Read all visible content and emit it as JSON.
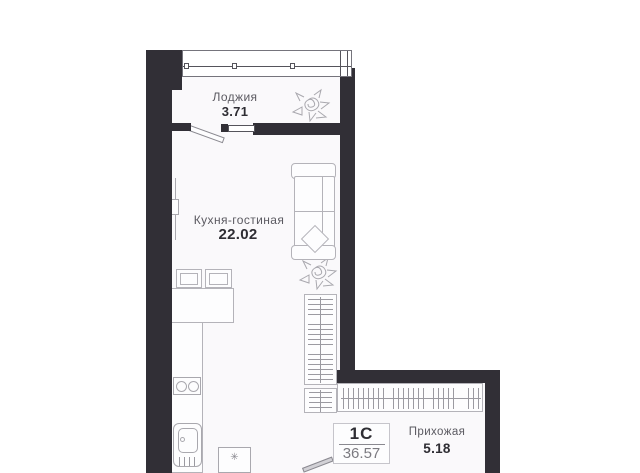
{
  "plan": {
    "badge": {
      "type_label": "1С",
      "total_area": "36.57"
    },
    "rooms": [
      {
        "name": "Лоджия",
        "area": "3.71"
      },
      {
        "name": "Кухня-гостиная",
        "area": "22.02"
      },
      {
        "name": "Прихожая",
        "area": "5.18"
      }
    ],
    "icons": {
      "fridge_glyph": "✳"
    },
    "colors": {
      "wall": "#312f36",
      "interior": "#faf9fb",
      "furniture_line": "#b4b3b9",
      "label_gray": "#5b5a61",
      "label_dark": "#2e2d33"
    }
  }
}
